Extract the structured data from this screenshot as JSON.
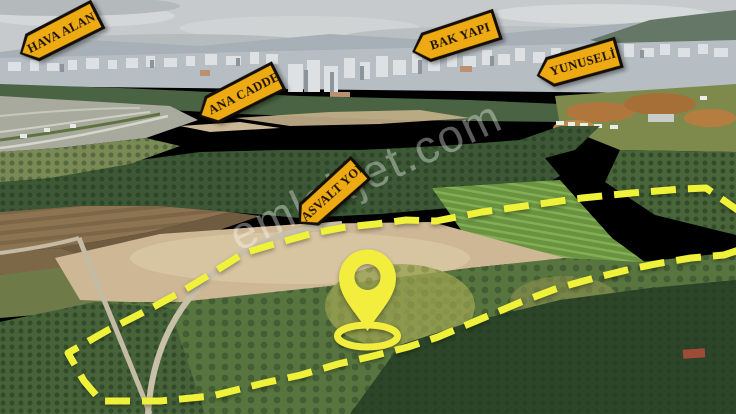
{
  "photo": {
    "alt": "Aerial drone photo of orchards and farmland in front of a city skyline under an overcast sky"
  },
  "signs": [
    {
      "id": "hava-alani",
      "label": "HAVA ALANI"
    },
    {
      "id": "ana-cadde",
      "label": "ANA CADDE"
    },
    {
      "id": "bak-yapi",
      "label": "BAK YAPI"
    },
    {
      "id": "yunuseli",
      "label": "YUNUSELİ"
    },
    {
      "id": "asvalt-yol",
      "label": "ASVALT YOL"
    }
  ],
  "watermark": {
    "text": "emlakjet.com"
  },
  "colors": {
    "sign_fill": "#edaa12",
    "sign_border": "#140f06",
    "sign_text": "#1b1206",
    "boundary_yellow": "#f0f23a",
    "pin_yellow": "#f3ee3e"
  },
  "overlay": {
    "boundary_dash": [
      25,
      12
    ],
    "boundary_points": [
      [
        742,
        213
      ],
      [
        706,
        188
      ],
      [
        682,
        189
      ],
      [
        632,
        193
      ],
      [
        582,
        198
      ],
      [
        532,
        205
      ],
      [
        482,
        212
      ],
      [
        436,
        221
      ],
      [
        406,
        220
      ],
      [
        376,
        224
      ],
      [
        346,
        227
      ],
      [
        314,
        233
      ],
      [
        281,
        242
      ],
      [
        244,
        253
      ],
      [
        214,
        272
      ],
      [
        181,
        292
      ],
      [
        144,
        312
      ],
      [
        108,
        330
      ],
      [
        68,
        353
      ],
      [
        84,
        381
      ],
      [
        101,
        401
      ],
      [
        160,
        401
      ],
      [
        212,
        396
      ],
      [
        264,
        383
      ],
      [
        301,
        375
      ],
      [
        338,
        364
      ],
      [
        373,
        356
      ],
      [
        408,
        347
      ],
      [
        438,
        337
      ],
      [
        476,
        321
      ],
      [
        521,
        302
      ],
      [
        558,
        288
      ],
      [
        598,
        277
      ],
      [
        631,
        269
      ],
      [
        661,
        263
      ],
      [
        691,
        258
      ],
      [
        724,
        255
      ],
      [
        742,
        249
      ]
    ],
    "pin": {
      "cx": 367.5,
      "cy": 278,
      "head_r": 28.5,
      "hole_r": 13,
      "tip_y": 331,
      "ring_cy": 336,
      "ring_rx": 30,
      "ring_ry": 11
    }
  }
}
